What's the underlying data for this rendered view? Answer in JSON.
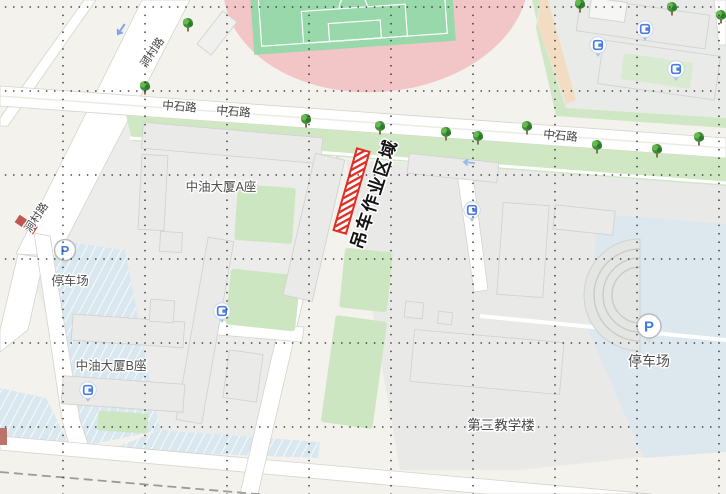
{
  "map_labels": {
    "zhongshi_road": [
      "中石路",
      "中石路",
      "中石路"
    ],
    "diagonal_road": [
      "涧村路",
      "涧村路"
    ],
    "crane_zone": "吊车作业区域",
    "building_a": "中油大厦A座",
    "building_b": "中油大厦B座",
    "teaching_building": "第三教学楼",
    "parking_left": "停车场",
    "parking_right": "停车场"
  },
  "icons": {
    "parking_symbol": "P",
    "gate": "gate-icon",
    "tree": "tree-icon",
    "one_way_arrow": "one-way-arrow-icon"
  },
  "colors": {
    "background": "#f4f2ec",
    "road_fill": "#ffffff",
    "road_edge": "#d6d3cd",
    "track_pink": "#f2c6c6",
    "field_green": "#98d8ab",
    "lawn_green": "#cfe7c3",
    "parking_blue": "#d9e7ef",
    "building_gray": "#eaebe9",
    "hatch_red": "#e02f26",
    "icon_blue": "#4a7de0",
    "label_gray": "#4f4f4f",
    "crane_text": "#141414",
    "grid_dot": "#2e2e2e"
  }
}
